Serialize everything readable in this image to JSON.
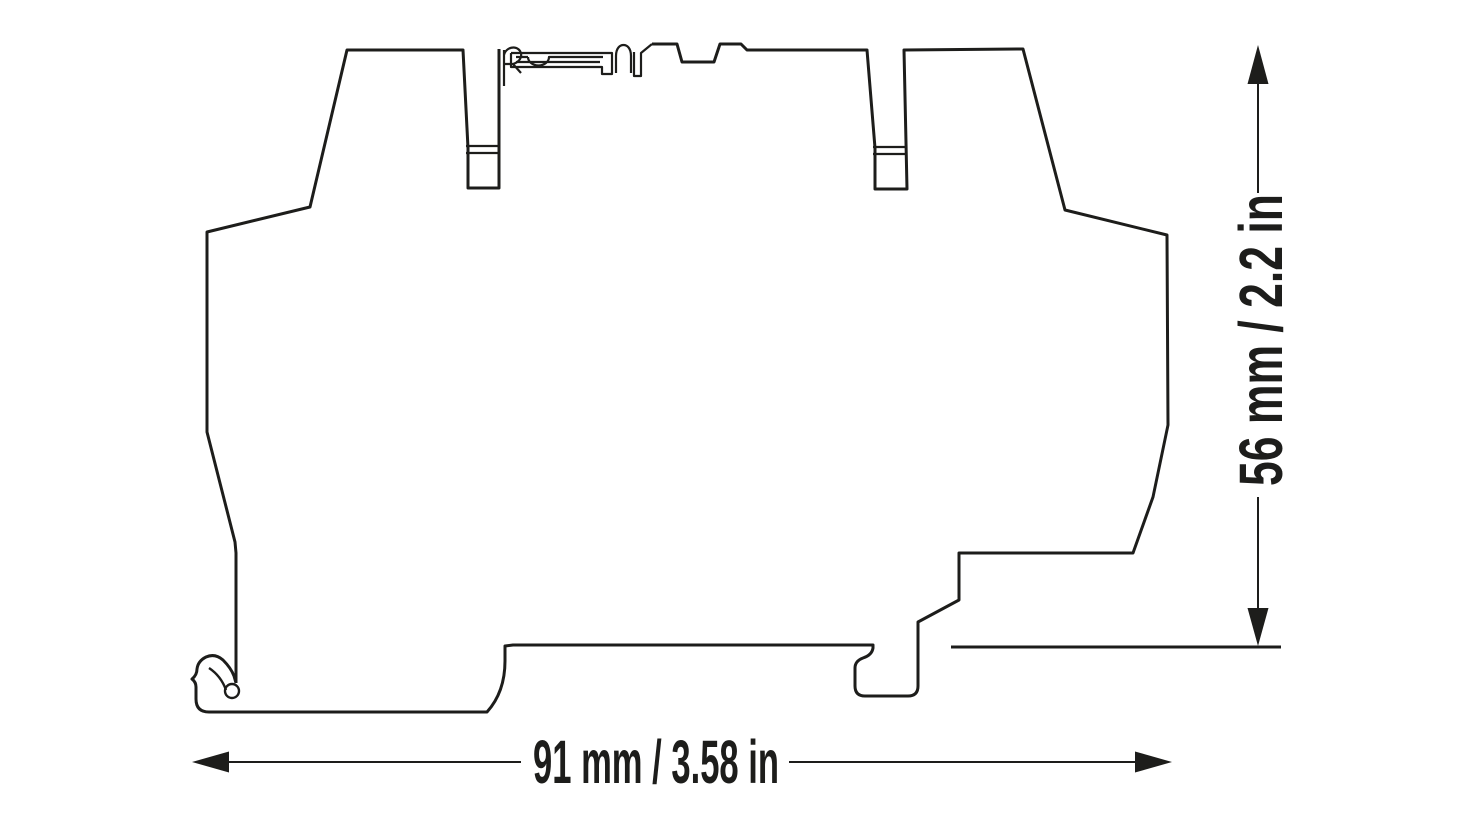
{
  "page": {
    "background_color": "#ffffff"
  },
  "drawing": {
    "kind": "technical-dimension-drawing",
    "subject": "din-rail-module-side-profile",
    "stroke_color": "#1d1d1b",
    "width_dimension": {
      "label": "91 mm / 3.58 in",
      "value_mm": 91,
      "value_in": 3.58
    },
    "height_dimension": {
      "label": "56 mm / 2.2 in",
      "value_mm": 56,
      "value_in": 2.2
    }
  }
}
